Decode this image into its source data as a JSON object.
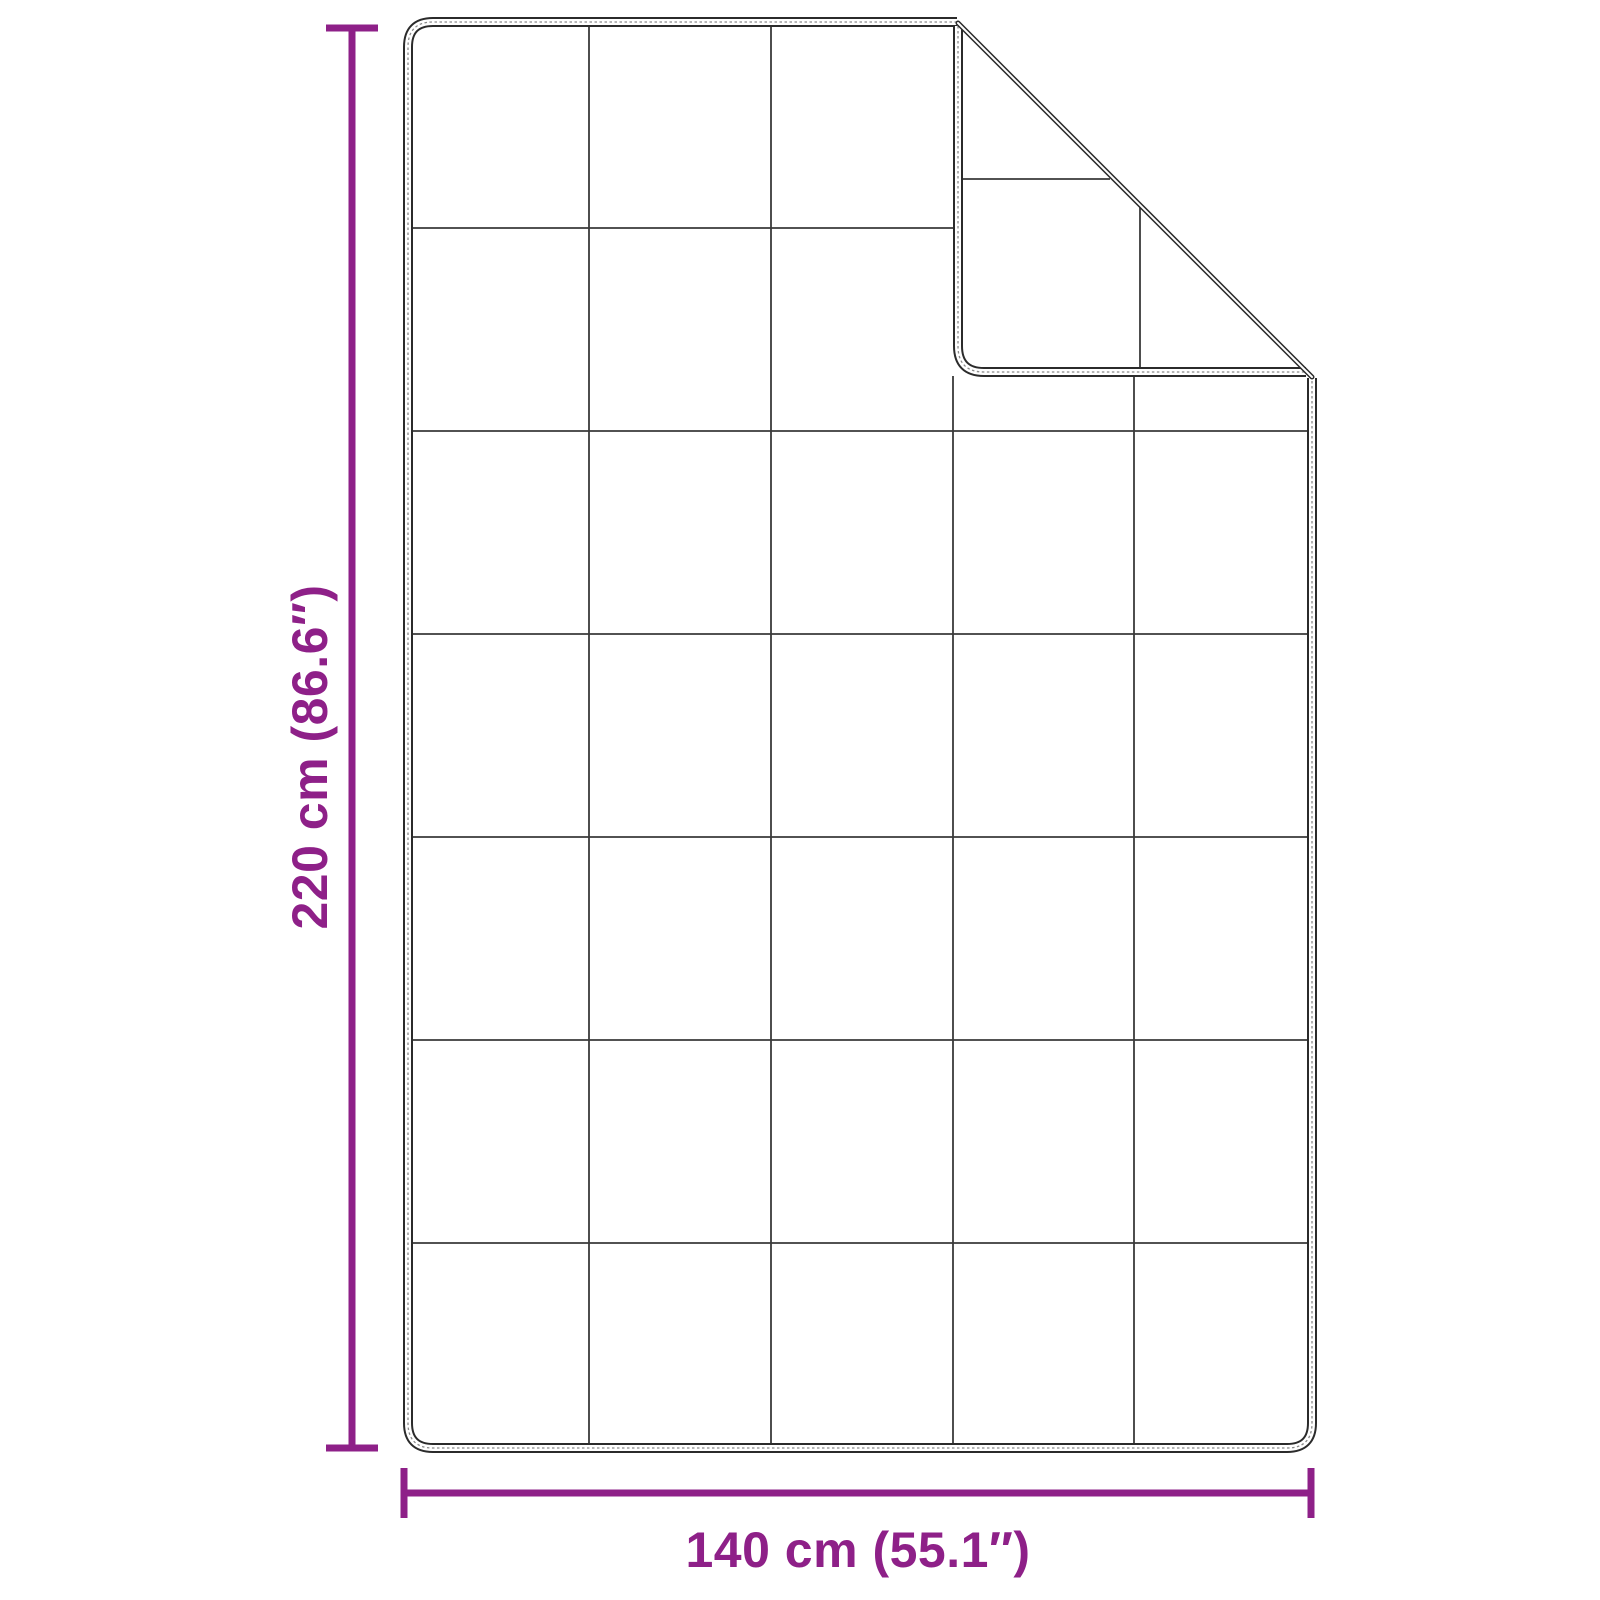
{
  "meta": {
    "type": "product-dimension-diagram",
    "subject": "quilted blanket with folded top-right corner"
  },
  "colors": {
    "accent": "#8E2088",
    "edge": "#2B2B2B",
    "grid": "#3A3A3A",
    "stitch": "#8A8A8A",
    "background": "#FFFFFF"
  },
  "dimensions": {
    "height_label": "220 cm (86.6″)",
    "width_label": "140 cm (55.1″)"
  },
  "blanket": {
    "grid_columns": 5,
    "grid_rows": 7,
    "folded_corner": "top-right"
  }
}
